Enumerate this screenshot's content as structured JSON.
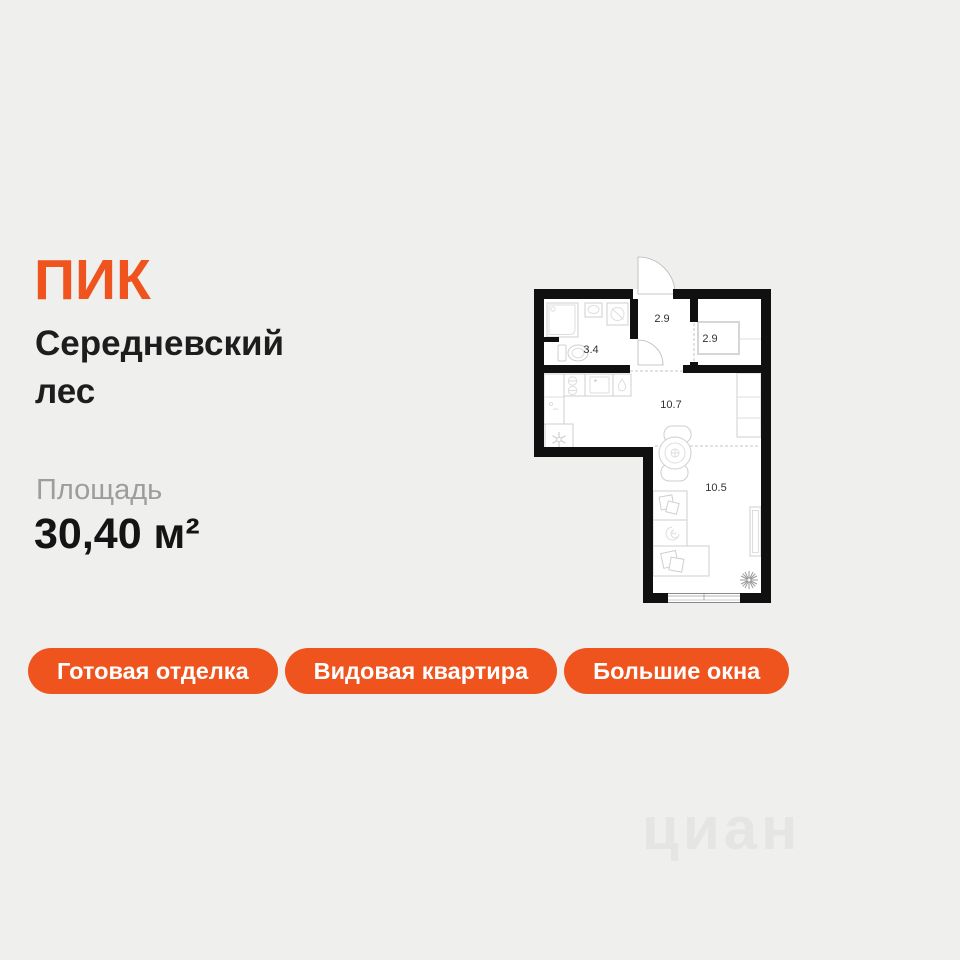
{
  "brand": {
    "logo_text": "ПИК",
    "accent_color": "#F0541E"
  },
  "listing": {
    "project_name": "Середневский лес",
    "area_label": "Площадь",
    "area_value": "30,40 м²"
  },
  "tags": [
    {
      "label": "Готовая отделка"
    },
    {
      "label": "Видовая квартира"
    },
    {
      "label": "Большие окна"
    }
  ],
  "floor_plan": {
    "rooms": [
      {
        "name": "bathroom",
        "label": "3.4"
      },
      {
        "name": "hallway",
        "label": "2.9"
      },
      {
        "name": "wardrobe",
        "label": "2.9"
      },
      {
        "name": "kitchen",
        "label": "10.7"
      },
      {
        "name": "living-room",
        "label": "10.5"
      }
    ],
    "wall_color": "#101010"
  },
  "watermark": {
    "text": "циан"
  },
  "colors": {
    "background": "#EFEFEE",
    "accent": "#F0541E"
  }
}
